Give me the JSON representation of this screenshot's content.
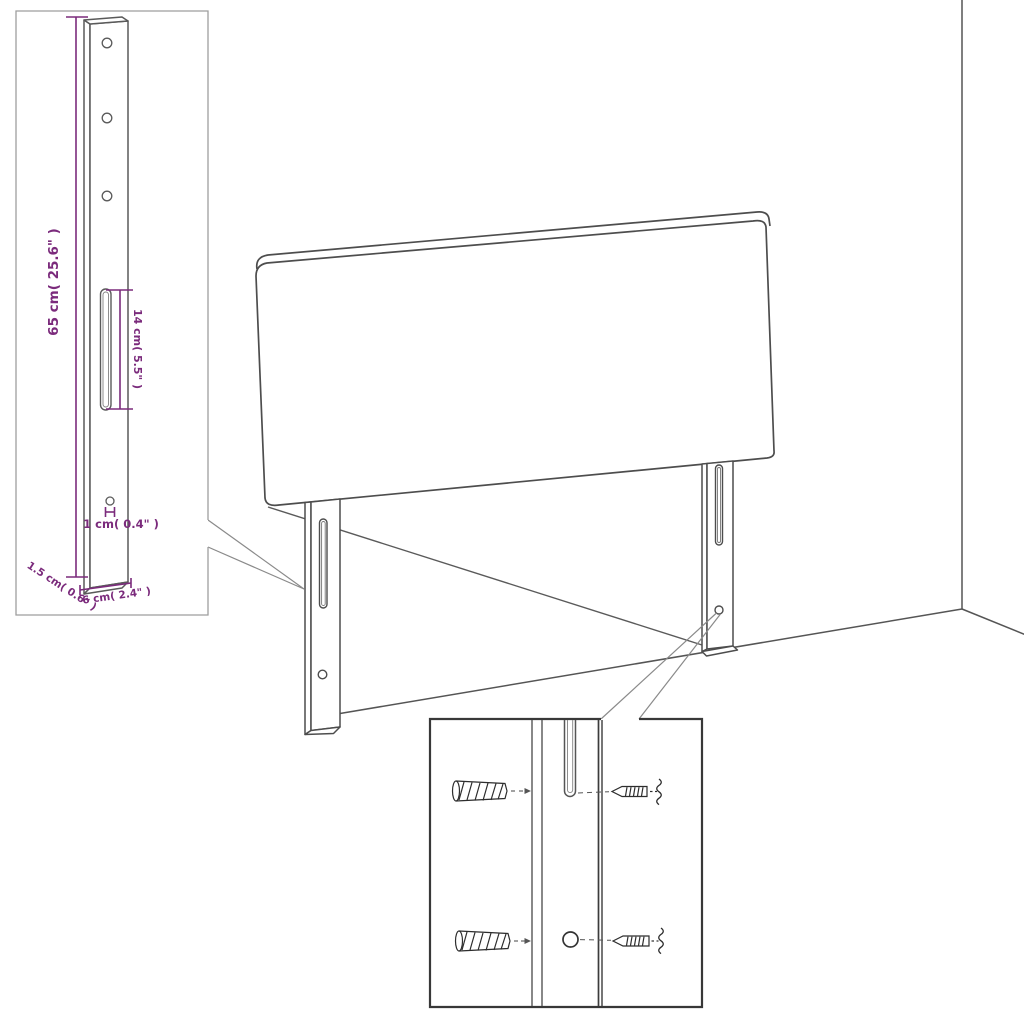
{
  "diagram": {
    "product": "headboard-with-mounting-legs",
    "background": "#ffffff",
    "outline_color": "#4d4d4d",
    "dimension_color": "#7b2b7c",
    "bracket_inset": {
      "dim_height": "65 cm( 25.6\" )",
      "dim_slot": "14 cm( 5.5\" )",
      "dim_hole": "1 cm( 0.4\" )",
      "dim_thickness": "1.5 cm( 0.6\" )",
      "dim_width": "6 cm( 2.4\" )"
    },
    "hardware_inset": {
      "items": [
        "wall-plug",
        "screw",
        "wall-plug",
        "screw",
        "mounting-slot",
        "mounting-hole"
      ]
    }
  }
}
